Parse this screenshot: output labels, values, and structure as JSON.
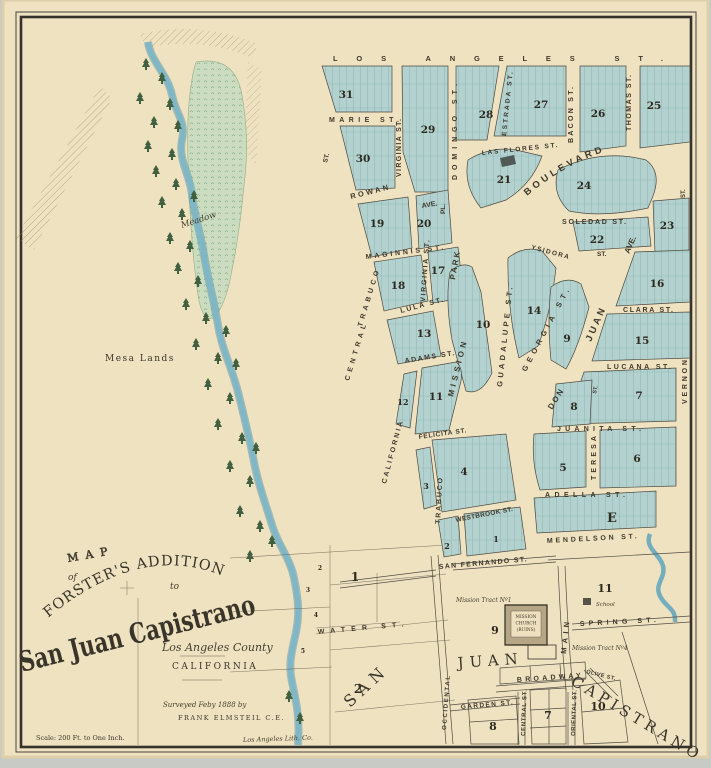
{
  "title_block": {
    "map_word": "MAP",
    "of_word": "of",
    "line_addition": "FORSTER'S ADDITION",
    "to_word": "to",
    "line_city": "San Juan Capistrano",
    "county": "Los Angeles County",
    "state": "CALIFORNIA",
    "surveyed_line": "Surveyed Feby 1888 by",
    "surveyor_line": "FRANK ELMSTEIL C.E.",
    "scale_note": "Scale: 200 Ft. to One Inch.",
    "lith_credit": "Los Angeles Lith. Co."
  },
  "terrain": {
    "meadow": "Meadow",
    "mesa_lands": "Mesa Lands"
  },
  "big_letters": {
    "san": "SAN",
    "juan": "JUAN",
    "capistrano": "CAPISTRANO"
  },
  "landmarks": {
    "mission_tract_1": "Mission Tract Nº1",
    "mission_tract_4": "Mission Tract Nº4",
    "school": "School",
    "church_line1": "MISSION",
    "church_line2": "CHURCH",
    "church_line3": "(RUINS)"
  },
  "streets": {
    "los_angeles": "LOS ANGELES ST.",
    "marie": "MARIE ST.",
    "virginia_upper": "VIRGINIA ST.",
    "virginia_lower": "VIRGINIA ST.",
    "domingo": "DOMINGO ST.",
    "domingo_pl": "PL.",
    "las_flores": "LAS FLORES ST.",
    "estrada": "ESTRADA ST.",
    "bacon": "BACON ST.",
    "thomas": "THOMAS ST.",
    "boulevard": "BOULEVARD",
    "rowan": "ROWAN",
    "rowan_ave": "AVE.",
    "soledad": "SOLEDAD ST.",
    "ysidora": "YSIDORA",
    "ysidora_st": "ST.",
    "maginnis": "MAGINNIS ST.",
    "park": "PARK",
    "trabuco_upper": "TRABUCO",
    "central_upper": "CENTRAL",
    "lula": "LULA ST.",
    "adams": "ADAMS ST.",
    "mission": "MISSION",
    "guadalupe": "GUADALUPE ST.",
    "georgia": "GEORGIA ST.",
    "juan_ave_word1": "JUAN",
    "juan_ave_word2": "AVE.",
    "clara": "CLARA ST.",
    "lucana": "LUCANA ST.",
    "vernon": "VERNON",
    "vernon_st": "ST.",
    "don": "DON",
    "don_st": "ST.",
    "juanita": "JUANITA ST.",
    "teresa": "TERESA",
    "felicita": "FELICITA ST.",
    "california": "CALIFORNIA",
    "trabuco_lower": "TRABUCO",
    "adella": "ADELLA ST.",
    "westbrook": "WESTBROOK ST.",
    "mendelson": "MENDELSON ST.",
    "san_fernando": "SAN FERNANDO ST.",
    "spring": "SPRING ST.",
    "main": "MAIN",
    "broadway": "BROADWAY",
    "garden": "GARDEN ST.",
    "occidental": "OCCIDENTAL",
    "central_lower": "CENTRAL ST.",
    "oriental": "ORIENTAL ST.",
    "olive": "OLIVE ST.",
    "water": "WATER ST.",
    "st_upper_left": "ST."
  },
  "blocks": {
    "n31": "31",
    "n29": "29",
    "n30": "30",
    "n28": "28",
    "n27": "27",
    "n26": "26",
    "n25": "25",
    "n21": "21",
    "n24": "24",
    "n19": "19",
    "n20": "20",
    "n22": "22",
    "n23": "23",
    "n17": "17",
    "n18": "18",
    "n13": "13",
    "n10": "10",
    "n14": "14",
    "n9_upper": "9",
    "n16": "16",
    "n15": "15",
    "n12": "12",
    "n11": "11",
    "n7_upper": "7",
    "n8_upper": "8",
    "n4": "4",
    "n3": "3",
    "n5": "5",
    "n6": "6",
    "e_block": "E",
    "n2_small": "2",
    "n1_small": "1",
    "n1_large": "1",
    "n2_large": "2",
    "n9_church": "9",
    "n11_south": "11",
    "n8_south": "8",
    "n7_south": "7",
    "n10_south": "10"
  },
  "lot_numbers": {
    "a": "2",
    "b": "3",
    "c": "4",
    "d": "5"
  }
}
